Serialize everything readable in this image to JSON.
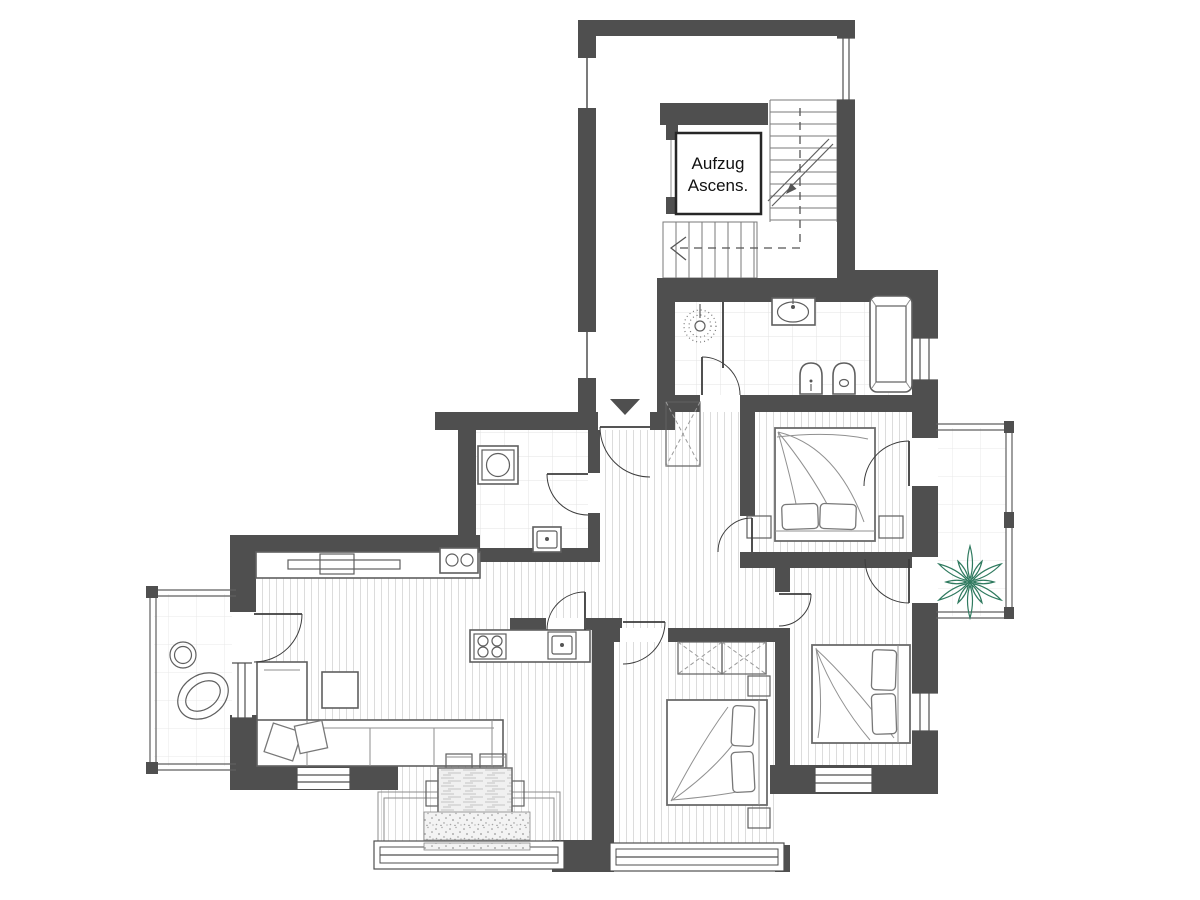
{
  "floorplan": {
    "elevator": {
      "label_line1": "Aufzug",
      "label_line2": "Ascens."
    },
    "colors": {
      "wall": "#4f4f4f",
      "floor": "#dcdcdc",
      "tile": "#e3e3e3",
      "btile": "#e9e9e9",
      "furniture": "#5f5f5f",
      "soft": "#8d8d8d",
      "door": "#3d3d3d",
      "window": "#4f4f4f",
      "plant": "#2f7a5f",
      "text": "#111111"
    }
  }
}
